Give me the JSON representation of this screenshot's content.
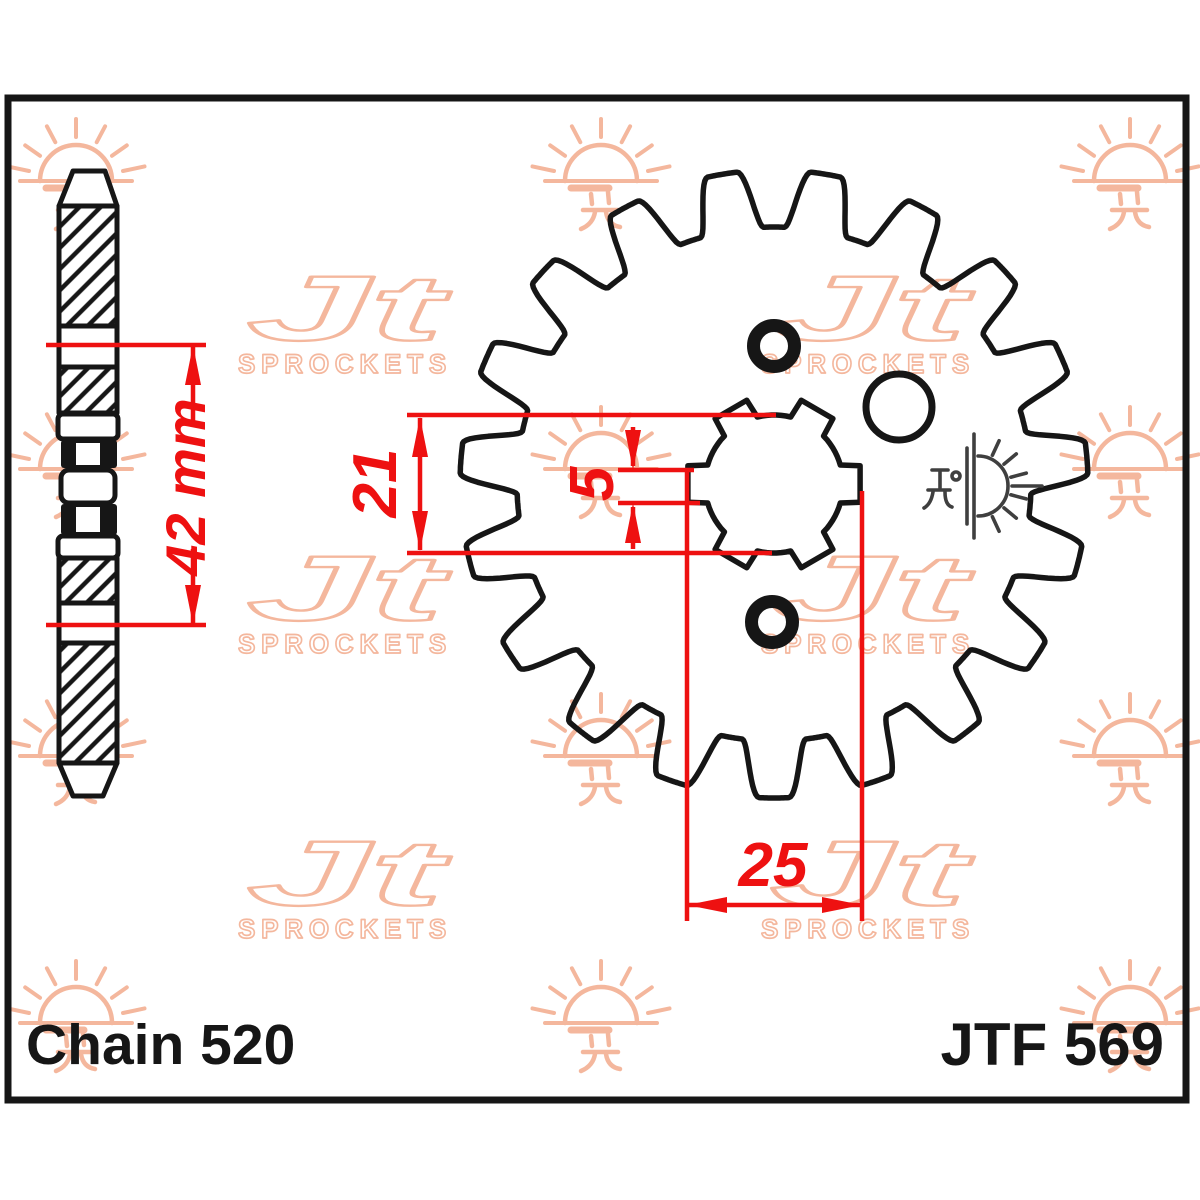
{
  "labels": {
    "chain": "Chain 520",
    "part": "JTF 569"
  },
  "dimensions": {
    "overall_width": "42 mm",
    "bore_inner_diameter": "21",
    "spline_groove_width": "5",
    "bore_outer_diameter": "25"
  },
  "watermark": {
    "brand": "Jt",
    "brand_sub": "SPROCKETS"
  },
  "drawing": {
    "view_left": "sprocket side cross-section",
    "view_right": "sprocket front view, 19 teeth, 6-spline bore, 2 bolt holes, 1 plain hole"
  },
  "colors": {
    "background": "#ffffff",
    "line_black": "#161616",
    "dimension_red": "#ee1111",
    "watermark_peach": "#f4b79d",
    "stamp_gray": "#3f3f3f"
  }
}
